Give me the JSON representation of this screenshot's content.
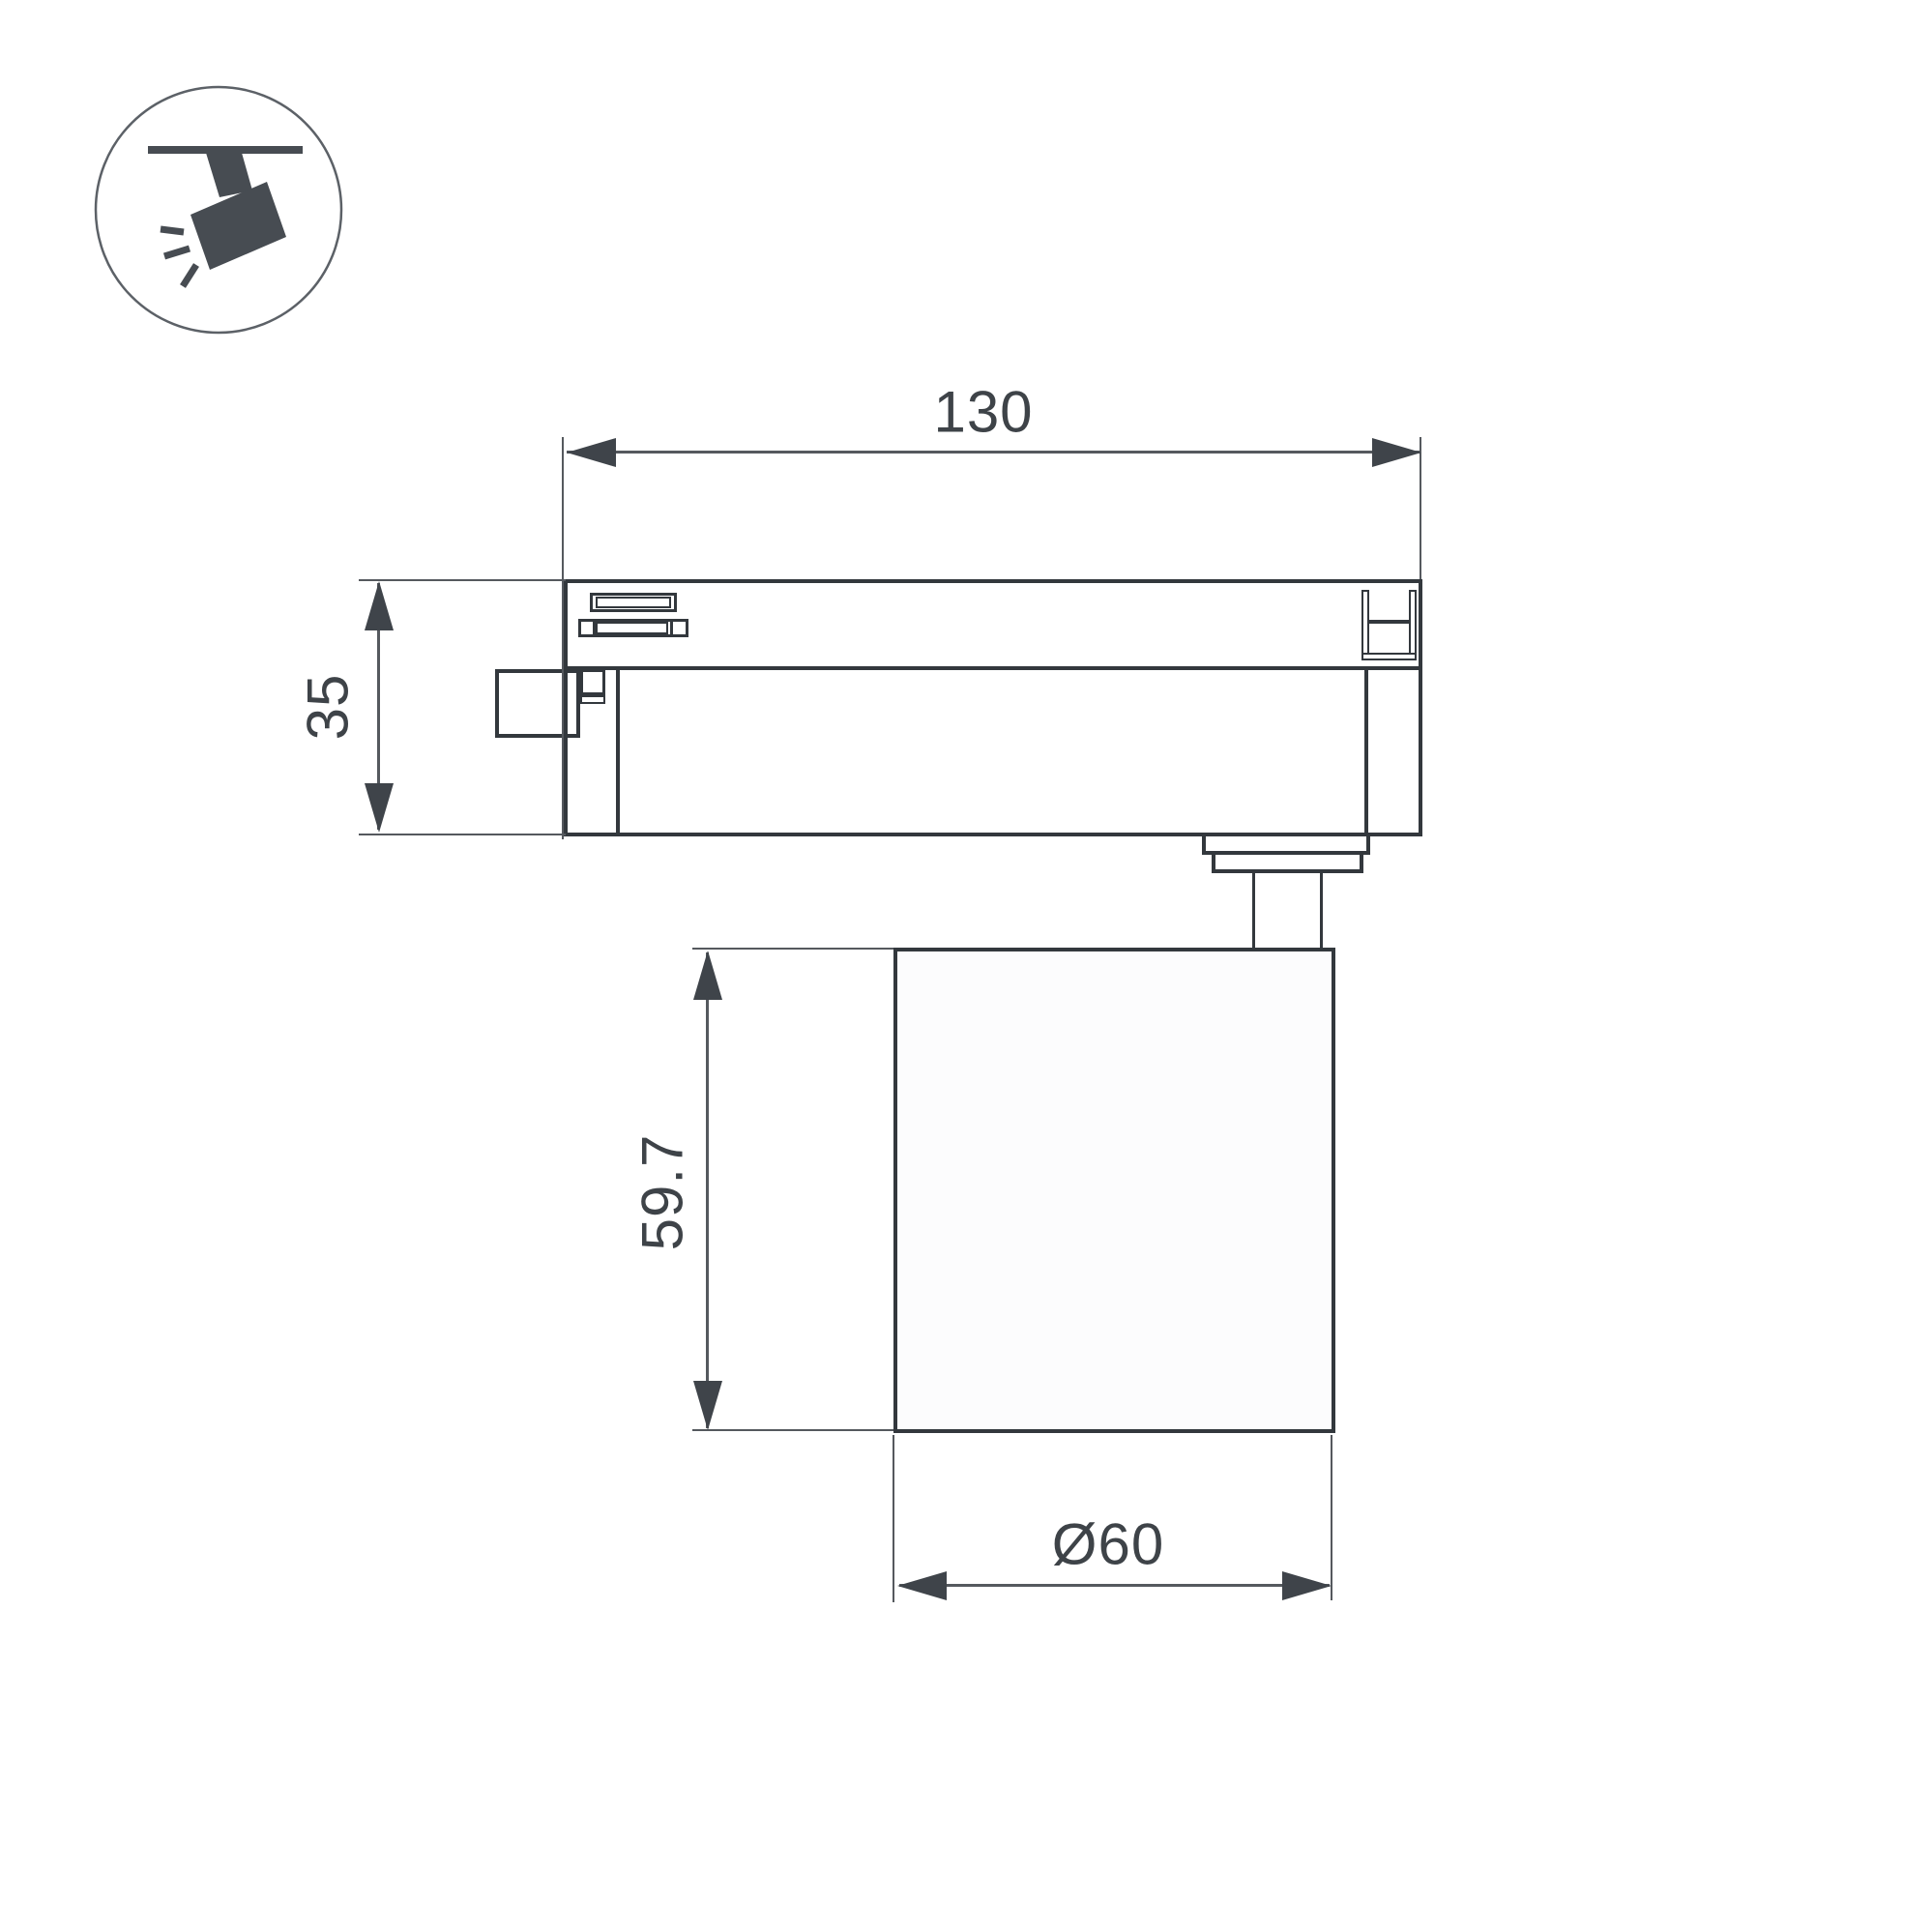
{
  "page": {
    "background": "#ffffff"
  },
  "icon": {
    "name": "track-spotlight-icon",
    "fill": "#474c52",
    "ring": "#5c6167"
  },
  "colors": {
    "body_line": "#33383d",
    "dim_line": "#55595e",
    "arrow": "#3f444a",
    "text": "#3e4348",
    "lamp_fill": "#fcfcfd"
  },
  "dimensions": {
    "track_width": {
      "label": "130"
    },
    "track_height": {
      "label": "35"
    },
    "body_height": {
      "label": "59.7"
    },
    "body_diameter": {
      "label": "Ø60"
    }
  }
}
